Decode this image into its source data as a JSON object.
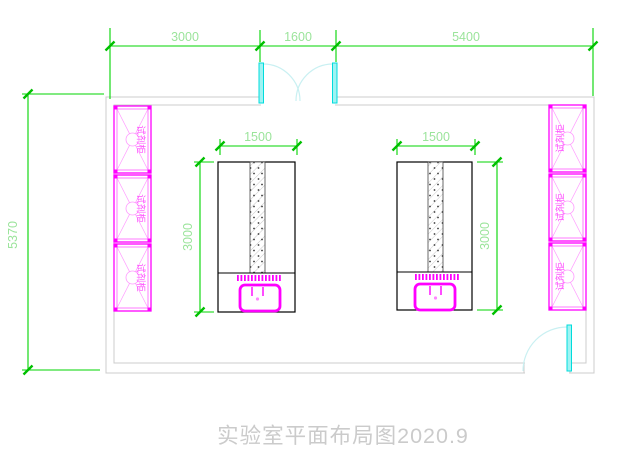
{
  "title": "实验室平面布局图2020.9",
  "dims": {
    "top_left": "3000",
    "top_middle": "1600",
    "top_right": "5400",
    "room_height": "5370",
    "bench1_width": "1500",
    "bench1_depth": "3000",
    "bench2_width": "1500",
    "bench2_depth": "3000"
  },
  "cabinets": {
    "left": [
      {
        "label": "试剂柜"
      },
      {
        "label": "试剂柜"
      },
      {
        "label": "试剂柜"
      }
    ],
    "right": [
      {
        "label": "试剂柜"
      },
      {
        "label": "试剂柜"
      },
      {
        "label": "试剂柜"
      }
    ]
  },
  "colors": {
    "dimension_line": "#00d400",
    "dimension_text": "#9be49b",
    "door": "#00e5e5",
    "door_arc": "#c9f0f2",
    "cabinet": "#ff00ff",
    "cabinet_light": "#ff9aff",
    "wall": "#cccccc",
    "bench_outline": "#000000",
    "title_text": "#cbcbcb"
  }
}
